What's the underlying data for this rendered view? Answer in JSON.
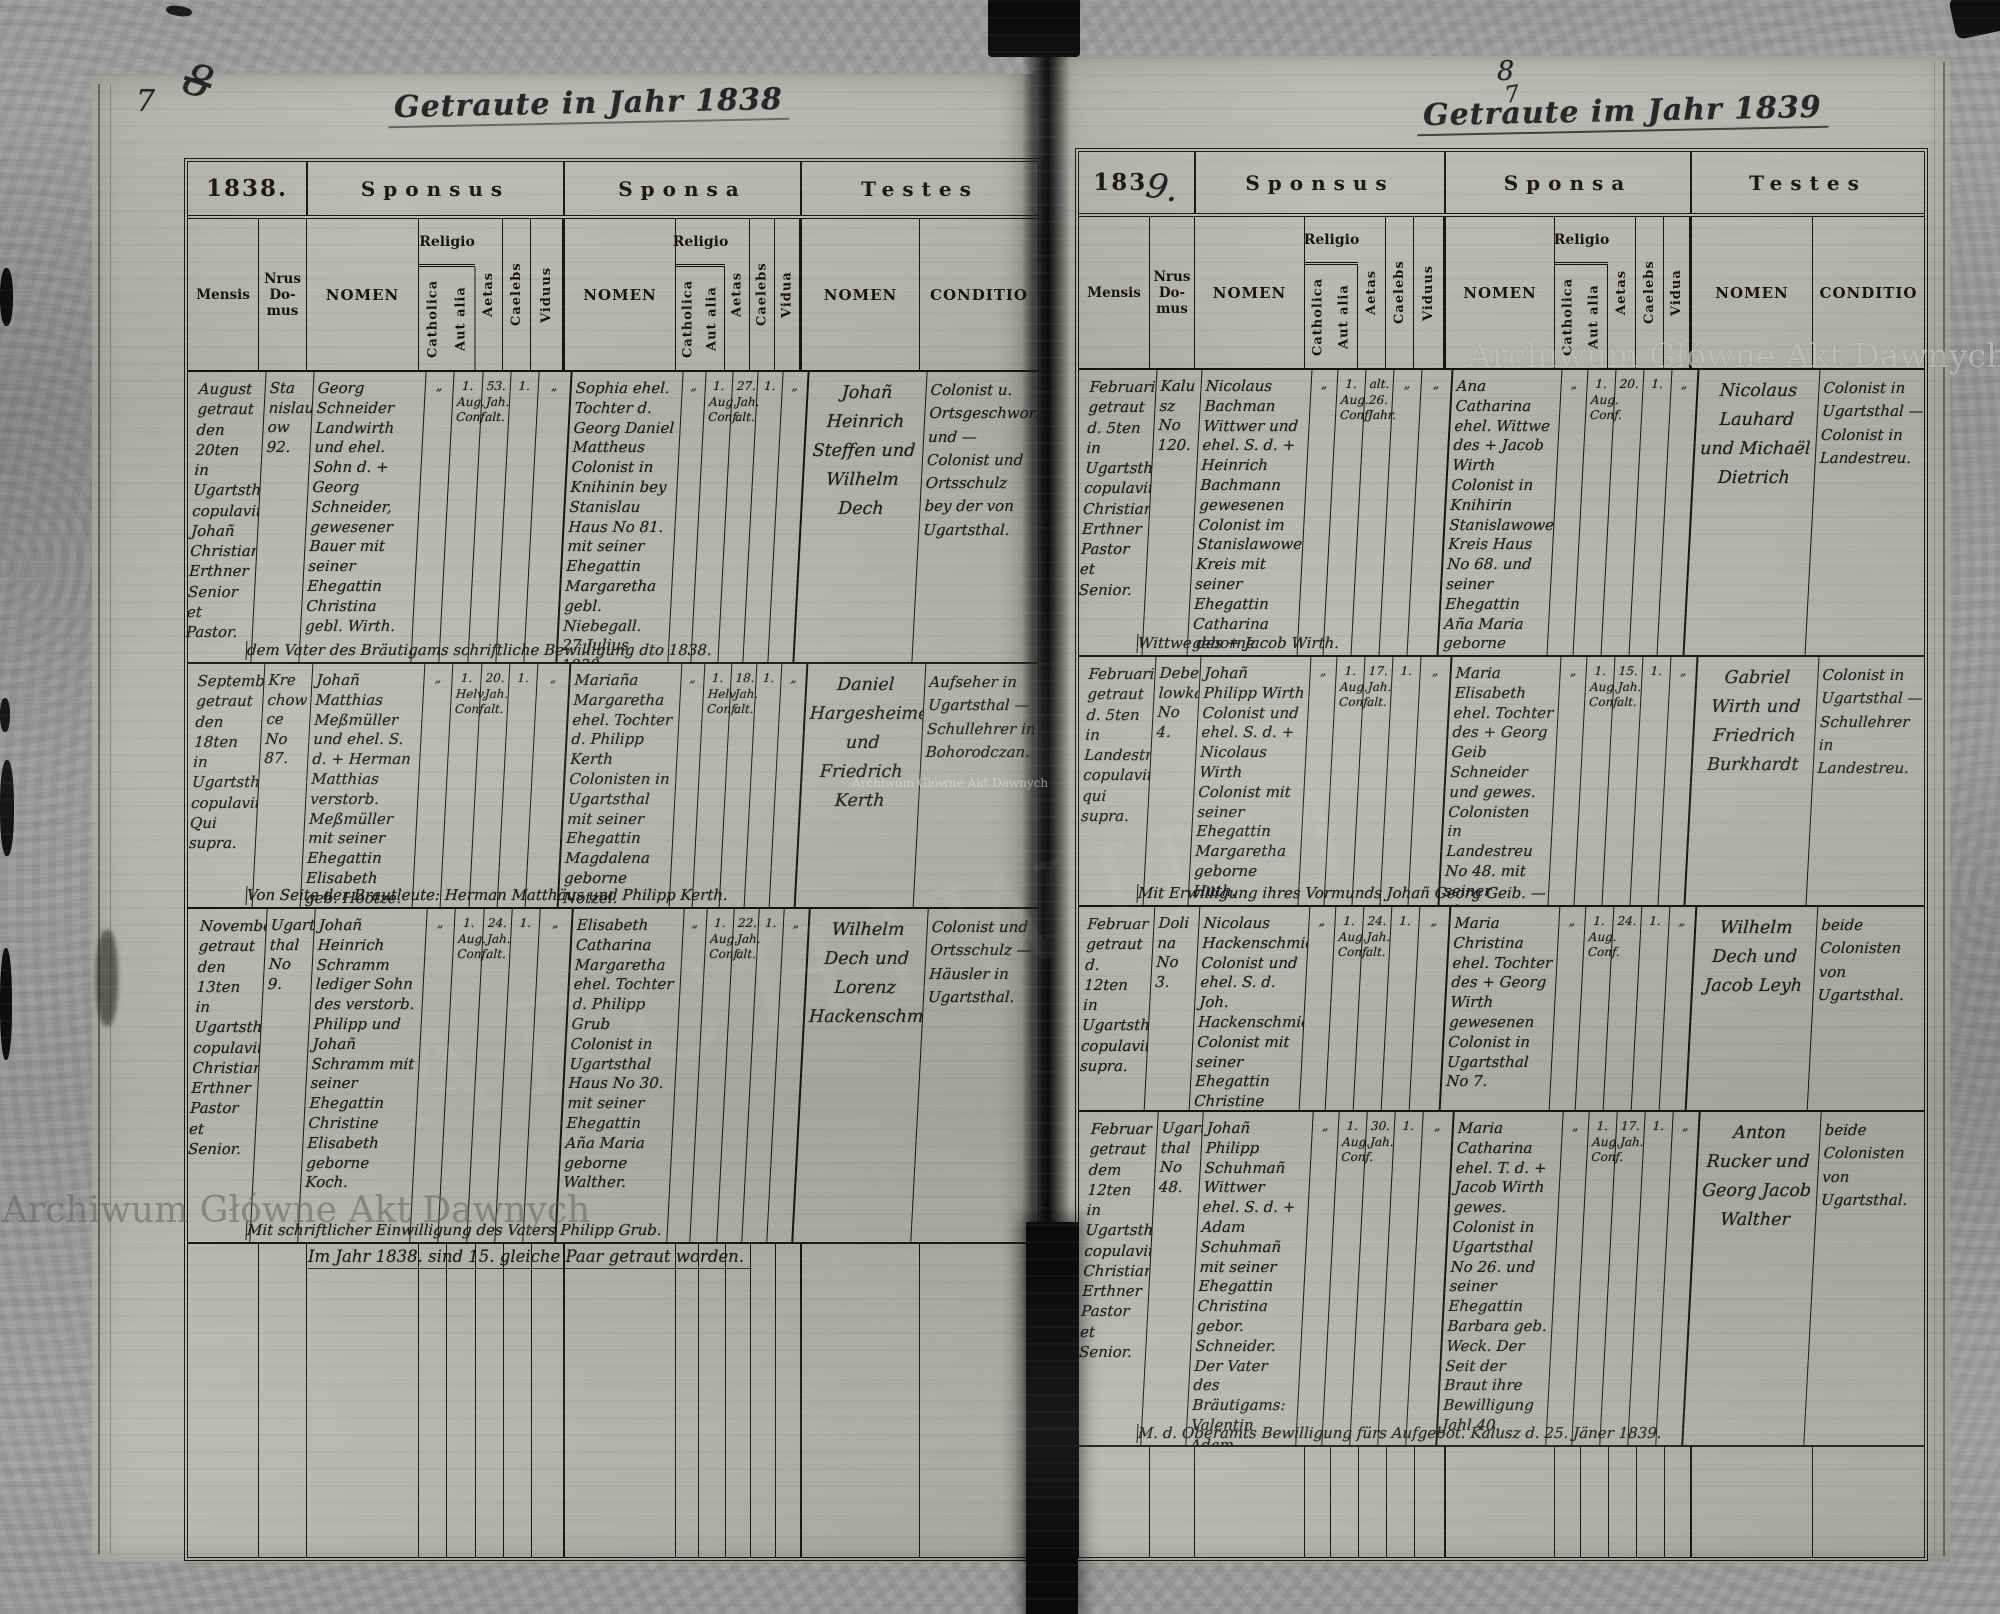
{
  "page_numbers": {
    "left": "7",
    "left_scribble": "8",
    "right": "8",
    "right_small": "7"
  },
  "watermark": {
    "text": "Archiwum Główne Akt Dawnych",
    "ghost": "ARCHIWUM"
  },
  "left_page": {
    "title": "Getraute in Jahr 1838",
    "year": "1838.",
    "header": {
      "sponsus": "Sponsus",
      "sponsa": "Sponsa",
      "testes": "Testes",
      "mensis": "Mensis",
      "nrus": "Nrus Do- mus",
      "nomen": "NOMEN",
      "conditio": "CONDITIO",
      "religio": "Religio",
      "catholica": "Catholica",
      "aut_alia": "Aut alia",
      "aetas": "Aetas",
      "caelebs": "Caelebs",
      "viduus": "Viduus",
      "vidua": "Vidua"
    },
    "rows": [
      {
        "mensis": "August getraut den 20ten in Ugartsthal. copulavit: Johañ Christian Erthner Senior et Pastor.",
        "domus": "Sta nislau ow 92.",
        "groom_nomen": "Georg Schneider Landwirth und ehel. Sohn d. + Georg Schneider, gewesener Bauer mit seiner Ehegattin Christina gebl. Wirth.",
        "groom_cath": "„",
        "groom_aut": "1. Aug. Conf.",
        "groom_aetas": "53. Jah. alt.",
        "groom_caelebs": "1.",
        "groom_viduus": "„",
        "bride_nomen": "Sophia ehel. Tochter d. Georg Daniel Mattheus Colonist in Knihinin bey Stanislau Haus No 81. mit seiner Ehegattin Margaretha gebl. Niebegall. 27 Julius 1838.",
        "bride_cath": "„",
        "bride_aut": "1. Aug. Conf.",
        "bride_aetas": "27. Jah. alt.",
        "bride_caelebs": "1.",
        "bride_vidua": "„",
        "testes_nomen": "Johañ Heinrich Steffen und Wilhelm Dech",
        "testes_conditio": "Colonist u. Ortsgeschwor., und — Colonist und Ortsschulz bey der von Ugartsthal.",
        "note": "dem Vater des Bräutigams schriftliche Bewilligung dto 1838."
      },
      {
        "mensis": "September getraut den 18ten in Ugartsthal. copulavit Qui supra.",
        "domus": "Kre chow ce No 87.",
        "groom_nomen": "Johañ Matthias Meßmüller und ehel. S. d. + Herman Matthias verstorb. Meßmüller mit seiner Ehegattin Elisabeth geb. Hootze.",
        "groom_cath": "„",
        "groom_aut": "1. Helv. Conf.",
        "groom_aetas": "20. Jah. alt.",
        "groom_caelebs": "1.",
        "groom_viduus": "„",
        "bride_nomen": "Mariaña Margaretha ehel. Tochter d. Philipp Kerth Colonisten in Ugartsthal mit seiner Ehegattin Magdalena geborne Notzel.",
        "bride_cath": "„",
        "bride_aut": "1. Helv. Conf.",
        "bride_aetas": "18. Jah. alt.",
        "bride_caelebs": "1.",
        "bride_vidua": "„",
        "testes_nomen": "Daniel Hargesheimer und Friedrich Kerth",
        "testes_conditio": "Aufseher in Ugartsthal — Schullehrer in Bohorodczan.",
        "note": "Von Seite der Brautleute: Herman Matthäus und Philipp Kerth."
      },
      {
        "mensis": "November getraut den 13ten in Ugartsthal. copulavit Christian Erthner Pastor et Senior.",
        "domus": "Ugarts thal No 9.",
        "groom_nomen": "Johañ Heinrich Schramm lediger Sohn des verstorb. Philipp und Johañ Schramm mit seiner Ehegattin Christine Elisabeth geborne Koch.",
        "groom_cath": "„",
        "groom_aut": "1. Aug. Conf.",
        "groom_aetas": "24. Jah. alt.",
        "groom_caelebs": "1.",
        "groom_viduus": "„",
        "bride_nomen": "Elisabeth Catharina Margaretha ehel. Tochter d. Philipp Grub Colonist in Ugartsthal Haus No 30. mit seiner Ehegattin Aña Maria geborne Walther.",
        "bride_cath": "„",
        "bride_aut": "1. Aug. Conf.",
        "bride_aetas": "22. Jah. alt.",
        "bride_caelebs": "1.",
        "bride_vidua": "„",
        "testes_nomen": "Wilhelm Dech und Lorenz Hackenschmied",
        "testes_conditio": "Colonist und Ortsschulz — Häusler in Ugartsthal.",
        "note": "Mit schriftlicher Einwilligung des Vaters Philipp Grub."
      }
    ],
    "summary": "Im Jahr 1838. sind 15. gleiche Paar getraut worden."
  },
  "right_page": {
    "title": "Getraute im Jahr 1839",
    "year_printed": "183",
    "year_hand": "9.",
    "header": {
      "sponsus": "Sponsus",
      "sponsa": "Sponsa",
      "testes": "Testes",
      "mensis": "Mensis",
      "nrus": "Nrus Do- mus",
      "nomen": "NOMEN",
      "conditio": "CONDITIO",
      "religio": "Religio",
      "catholica": "Catholica",
      "aut_alia": "Aut alia",
      "aetas": "Aetas",
      "caelebs": "Caelebs",
      "viduus": "Viduus",
      "vidua": "Vidua"
    },
    "rows": [
      {
        "mensis": "Februarius getraut d. 5ten in Ugartsthal. copulavit: Christian Erthner Pastor et Senior.",
        "domus": "Kalu sz No 120.",
        "groom_nomen": "Nicolaus Bachman Wittwer und ehel. S. d. + Heinrich Bachmann gewesenen Colonist im Stanislawower Kreis mit seiner Ehegattin Catharina geborne Beutelmann.",
        "groom_cath": "„",
        "groom_aut": "1. Aug. Conf.",
        "groom_aetas": "alt. 26. Jahr.",
        "groom_caelebs": "„",
        "groom_viduus": "„",
        "bride_nomen": "Ana Catharina ehel. Wittwe des + Jacob Wirth Colonist in Knihirin Stanislawower Kreis Haus No 68. und seiner Ehegattin Aña Maria geborne Behr.",
        "bride_cath": "„",
        "bride_aut": "1. Aug. Conf.",
        "bride_aetas": "20.",
        "bride_caelebs": "1.",
        "bride_vidua": "„",
        "testes_nomen": "Nicolaus Lauhard und Michaël Dietrich",
        "testes_conditio": "Colonist in Ugartsthal — Colonist in Landestreu.",
        "note": "Wittwe des + Jacob Wirth."
      },
      {
        "mensis": "Februarius getraut d. 5ten in Landestreu. copulavit qui supra.",
        "domus": "Debe lowka No 4.",
        "groom_nomen": "Johañ Philipp Wirth Colonist und ehel. S. d. + Nicolaus Wirth Colonist mit seiner Ehegattin Margaretha geborne Huth.",
        "groom_cath": "„",
        "groom_aut": "1. Aug. Conf.",
        "groom_aetas": "17. Jah. alt.",
        "groom_caelebs": "1.",
        "groom_viduus": "„",
        "bride_nomen": "Maria Elisabeth ehel. Tochter des + Georg Geib Schneider und gewes. Colonisten in Landestreu No 48. mit seiner Ehegattin Maria Elisabeth geborne Koch.",
        "bride_cath": "„",
        "bride_aut": "1. Aug. Conf.",
        "bride_aetas": "15. Jah. alt.",
        "bride_caelebs": "1.",
        "bride_vidua": "„",
        "testes_nomen": "Gabriel Wirth und Friedrich Burkhardt",
        "testes_conditio": "Colonist in Ugartsthal — Schullehrer in Landestreu.",
        "note": "Mit Erwilligung ihres Vormunds Johañ Georg Geib. —"
      },
      {
        "mensis": "Februar getraut d. 12ten in Ugartsthal. copulavit supra.",
        "domus": "Doli na No 3.",
        "groom_nomen": "Nicolaus Hackenschmied Colonist und ehel. S. d. Joh. Hackenschmied Colonist mit seiner Ehegattin Christine geb. Philipps.",
        "groom_cath": "„",
        "groom_aut": "1. Aug. Conf.",
        "groom_aetas": "24. Jah. alt.",
        "groom_caelebs": "1.",
        "groom_viduus": "„",
        "bride_nomen": "Maria Christina ehel. Tochter des + Georg Wirth gewesenen Colonist in Ugartsthal No 7.",
        "bride_cath": "„",
        "bride_aut": "1. Aug. Conf.",
        "bride_aetas": "24.",
        "bride_caelebs": "1.",
        "bride_vidua": "„",
        "testes_nomen": "Wilhelm Dech und Jacob Leyh",
        "testes_conditio": "beide Colonisten von Ugartsthal.",
        "note": ""
      },
      {
        "mensis": "Februar getraut dem 12ten in Ugartsthal. copulavit Christian Erthner Pastor et Senior.",
        "domus": "Ugarts thal No 48.",
        "groom_nomen": "Johañ Philipp Schuhmañ Wittwer ehel. S. d. + Adam Schuhmañ mit seiner Ehegattin Christina gebor. Schneider. Der Vater des Bräutigams: Valentin Adam Schuhmañ",
        "groom_cath": "„",
        "groom_aut": "1. Aug. Conf.",
        "groom_aetas": "30. Jah.",
        "groom_caelebs": "1.",
        "groom_viduus": "„",
        "bride_nomen": "Maria Catharina ehel. T. d. + Jacob Wirth gewes. Colonist in Ugartsthal No 26. und seiner Ehegattin Barbara geb. Weck. Der Seit der Braut ihre Bewilligung Jahl 40.",
        "bride_cath": "„",
        "bride_aut": "1. Aug. Conf.",
        "bride_aetas": "17. Jah.",
        "bride_caelebs": "1.",
        "bride_vidua": "„",
        "testes_nomen": "Anton Rucker und Georg Jacob Walther",
        "testes_conditio": "beide Colonisten von Ugartsthal.",
        "note": "M. d. Oberamts Bewilligung fürs Aufgebot. Kalusz d. 25. Jäner 1839."
      }
    ]
  }
}
